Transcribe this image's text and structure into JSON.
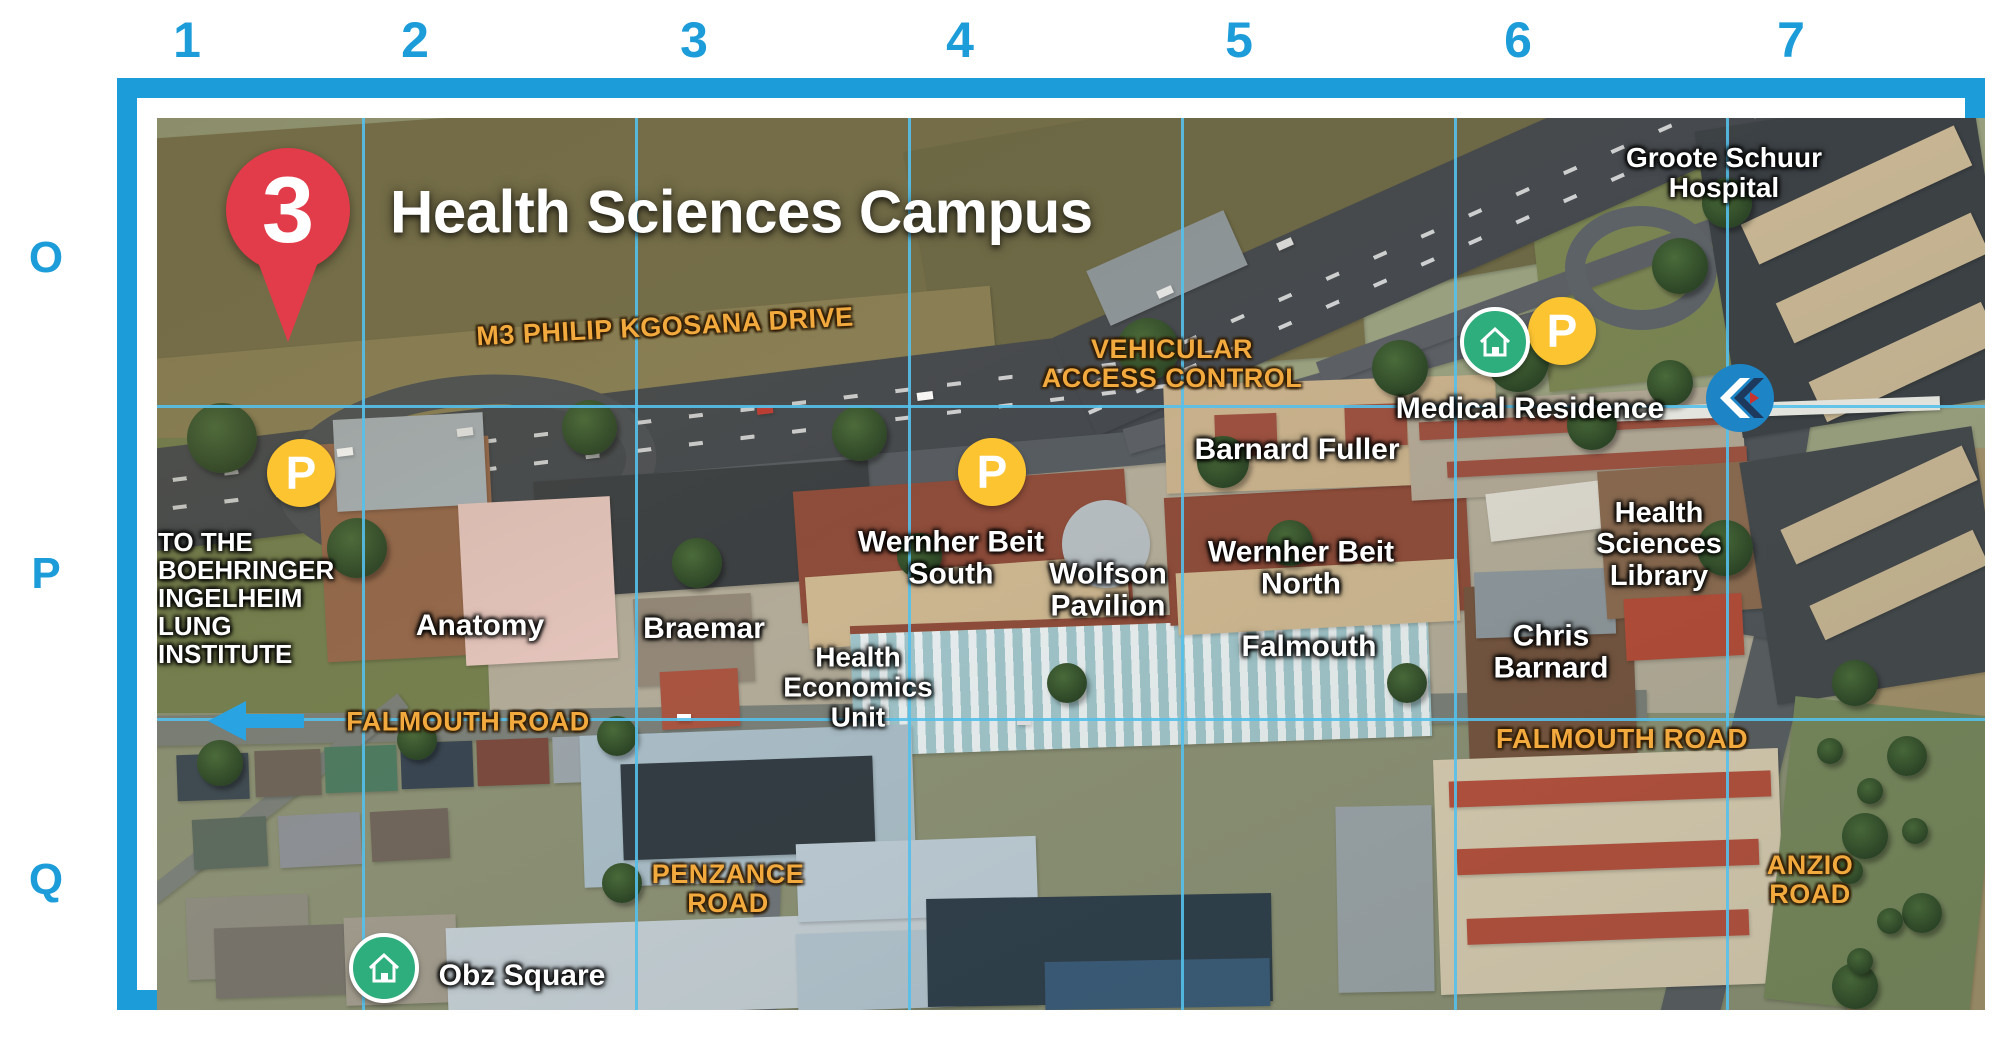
{
  "map_title": "Health Sciences Campus",
  "pin": {
    "number": "3",
    "x": 268,
    "y": 190
  },
  "grid": {
    "columns": [
      {
        "label": "1",
        "x": 187
      },
      {
        "label": "2",
        "x": 415
      },
      {
        "label": "3",
        "x": 694
      },
      {
        "label": "4",
        "x": 960
      },
      {
        "label": "5",
        "x": 1239
      },
      {
        "label": "6",
        "x": 1518
      },
      {
        "label": "7",
        "x": 1791
      }
    ],
    "rows": [
      {
        "label": "O",
        "y": 258
      },
      {
        "label": "P",
        "y": 574
      },
      {
        "label": "Q",
        "y": 880
      }
    ],
    "v_lines": [
      342,
      615,
      888,
      1161,
      1434,
      1706
    ],
    "h_lines": [
      385,
      698
    ]
  },
  "labels": [
    {
      "id": "groote-schuur-hospital",
      "lines": [
        "Groote Schuur",
        "Hospital"
      ],
      "x": 1704,
      "y": 153,
      "kind": "building",
      "fs": 28
    },
    {
      "id": "m3-philip-kgosana-drive",
      "lines": [
        "M3 PHILIP KGOSANA DRIVE"
      ],
      "x": 645,
      "y": 307,
      "kind": "road",
      "fs": 27,
      "rot": -3
    },
    {
      "id": "vehicular-access-control",
      "lines": [
        "VEHICULAR",
        "ACCESS CONTROL"
      ],
      "x": 1152,
      "y": 344,
      "kind": "road",
      "fs": 27
    },
    {
      "id": "medical-residence",
      "lines": [
        "Medical Residence"
      ],
      "x": 1510,
      "y": 389,
      "kind": "building",
      "fs": 30
    },
    {
      "id": "barnard-fuller",
      "lines": [
        "Barnard Fuller"
      ],
      "x": 1277,
      "y": 430,
      "kind": "building",
      "fs": 30
    },
    {
      "id": "wernher-beit-south",
      "lines": [
        "Wernher Beit",
        "South"
      ],
      "x": 931,
      "y": 539,
      "kind": "building",
      "fs": 30
    },
    {
      "id": "wolfson-pavilion",
      "lines": [
        "Wolfson",
        "Pavilion"
      ],
      "x": 1088,
      "y": 571,
      "kind": "building",
      "fs": 30
    },
    {
      "id": "wernher-beit-north",
      "lines": [
        "Wernher Beit",
        "North"
      ],
      "x": 1281,
      "y": 549,
      "kind": "building",
      "fs": 30
    },
    {
      "id": "falmouth-building",
      "lines": [
        "Falmouth"
      ],
      "x": 1289,
      "y": 627,
      "kind": "building",
      "fs": 30
    },
    {
      "id": "chris-barnard",
      "lines": [
        "Chris",
        "Barnard"
      ],
      "x": 1531,
      "y": 633,
      "kind": "building",
      "fs": 30
    },
    {
      "id": "health-sciences-library",
      "lines": [
        "Health",
        "Sciences",
        "Library"
      ],
      "x": 1639,
      "y": 525,
      "kind": "building",
      "fs": 29
    },
    {
      "id": "anatomy",
      "lines": [
        "Anatomy"
      ],
      "x": 460,
      "y": 606,
      "kind": "building",
      "fs": 30
    },
    {
      "id": "braemar",
      "lines": [
        "Braemar"
      ],
      "x": 684,
      "y": 609,
      "kind": "building",
      "fs": 30
    },
    {
      "id": "health-economics-unit",
      "lines": [
        "Health",
        "Economics",
        "Unit"
      ],
      "x": 838,
      "y": 668,
      "kind": "building",
      "fs": 28
    },
    {
      "id": "to-the-boehringer-ingelheim-lung-institute",
      "lines": [
        "TO THE",
        "BOEHRINGER",
        "INGELHEIM",
        "LUNG",
        "INSTITUTE"
      ],
      "x": 138,
      "y": 508,
      "kind": "building",
      "fs": 26,
      "align": "left"
    },
    {
      "id": "falmouth-road-west",
      "lines": [
        "FALMOUTH ROAD"
      ],
      "x": 448,
      "y": 702,
      "kind": "road",
      "fs": 27
    },
    {
      "id": "falmouth-road-east",
      "lines": [
        "FALMOUTH ROAD"
      ],
      "x": 1602,
      "y": 719,
      "kind": "road",
      "fs": 28
    },
    {
      "id": "penzance-road",
      "lines": [
        "PENZANCE",
        "ROAD"
      ],
      "x": 708,
      "y": 869,
      "kind": "road",
      "fs": 27
    },
    {
      "id": "anzio-road",
      "lines": [
        "ANZIO",
        "ROAD"
      ],
      "x": 1790,
      "y": 860,
      "kind": "road",
      "fs": 27
    },
    {
      "id": "obz-square",
      "lines": [
        "Obz Square"
      ],
      "x": 502,
      "y": 956,
      "kind": "building",
      "fs": 30
    }
  ],
  "markers": {
    "parking_glyph": "P",
    "parking": [
      {
        "x": 281,
        "y": 453
      },
      {
        "x": 972,
        "y": 452
      },
      {
        "x": 1542,
        "y": 311
      }
    ],
    "residence": [
      {
        "x": 1475,
        "y": 322
      },
      {
        "x": 364,
        "y": 948
      }
    ],
    "chevron": {
      "x": 1720,
      "y": 378
    },
    "direction_arrow": {
      "x": 238,
      "y": 701,
      "direction": "left"
    }
  },
  "colors": {
    "accent_blue": "#1c9cd8",
    "grid_line_blue": "#55c0ea",
    "label_orange": "#f2a93d",
    "pin_red": "#e23b49",
    "parking_yellow": "#fcc431",
    "residence_green": "#2fae7d",
    "chevron_blue": "#1d84c6",
    "arrow_blue": "#2aa3e3"
  }
}
